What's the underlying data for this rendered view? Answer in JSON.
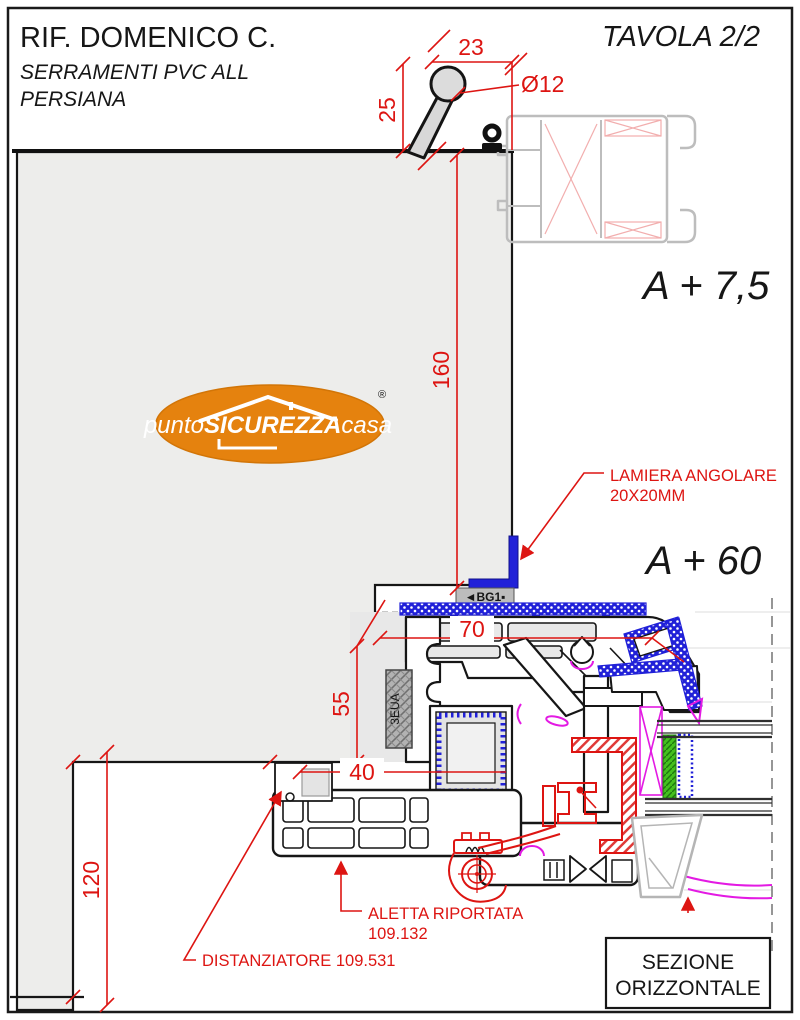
{
  "header": {
    "title": "RIF. DOMENICO C.",
    "subtitle_line1": "SERRAMENTI PVC ALL",
    "subtitle_line2": "PERSIANA",
    "sheet": "TAVOLA 2/2"
  },
  "logo": {
    "prefix": "punto",
    "brand": "SICUREZZA",
    "suffix": "casa",
    "registered": "®"
  },
  "dims": {
    "handle_width": "23",
    "handle_diameter": "Ø12",
    "handle_offset": "25",
    "wall_overlap": "160",
    "frame_width_70": "70",
    "frame_depth_55": "55",
    "offset_40": "40",
    "reveal_120": "120"
  },
  "annotations": {
    "level_top": "A + 7,5",
    "level_mid": "A + 60",
    "lamiera_line1": "LAMIERA ANGOLARE",
    "lamiera_line2": "20X20MM",
    "aletta_line1": "ALETTA RIPORTATA",
    "aletta_line2": "109.132",
    "distanziatore": "DISTANZIATORE 109.531",
    "badge": "◄BG1▪",
    "foam_code": "3EUA",
    "section_line1": "SEZIONE",
    "section_line2": "ORIZZONTALE"
  },
  "colors": {
    "dimension_red": "#dd1512",
    "profile_blue": "#2121d8",
    "gasket_magenta": "#e31ae3",
    "glazing_green": "#45c01f",
    "alu_gray": "#bdbdbd",
    "wall_gray": "#ededeb",
    "logo_orange": "#e5820e",
    "line_black": "#161616"
  }
}
